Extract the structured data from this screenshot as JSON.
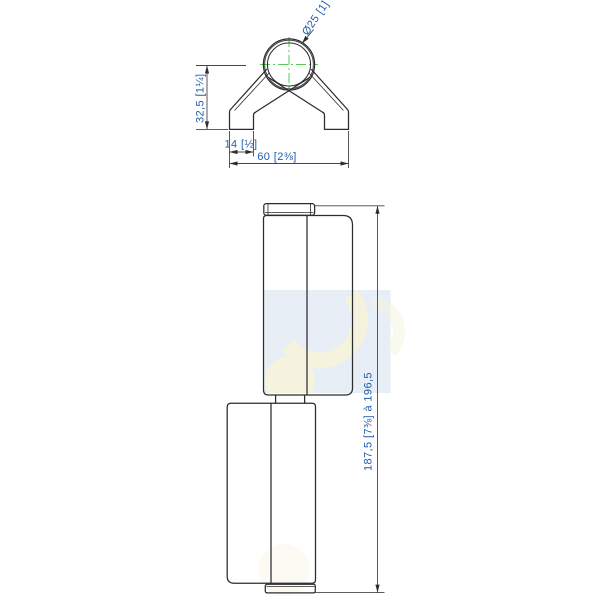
{
  "labels": {
    "top_view": {
      "diameter": "Ø25 [1]",
      "height": "32,5 [1¼]",
      "foot_width": "14 [½]",
      "overall_width": "60 [2⅜]"
    },
    "side_view": {
      "overall_length": "187,5 [7⅜] à 196,5"
    }
  },
  "colors": {
    "drawing_line": "#2c2c2f",
    "dimension_text_blue": "#1e5eae",
    "centerline_green": "#55cf55",
    "watermark_tint": "#e8eef5",
    "watermark_cream": "#f5f3de"
  }
}
